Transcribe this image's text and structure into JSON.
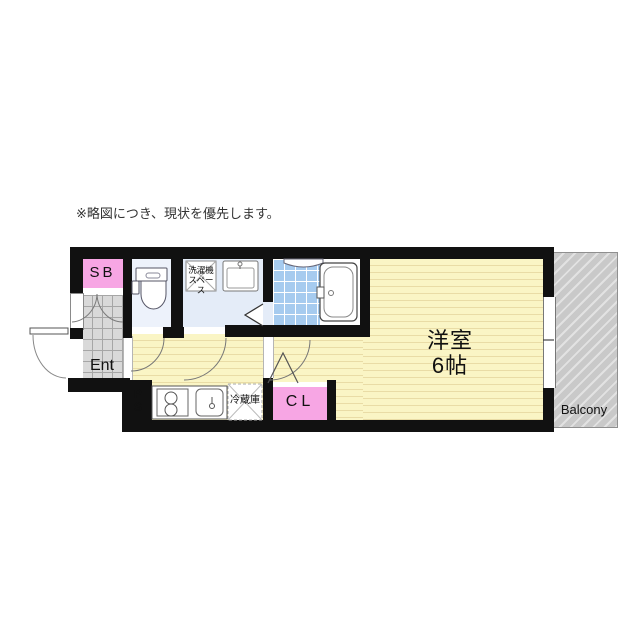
{
  "disclaimer": "※略図につき、現状を優先します。",
  "rooms": {
    "shoe_box": {
      "label": "SB"
    },
    "entrance": {
      "label": "Ent"
    },
    "pipe_space": {
      "top": "P",
      "bottom": "S"
    },
    "closet": {
      "label": "CL"
    },
    "main_room": {
      "name": "洋室",
      "size": "6帖"
    },
    "balcony": {
      "label": "Balcony"
    },
    "kitchen": {
      "fridge_label": "冷蔵庫"
    },
    "washroom": {
      "washer_line1": "洗濯機",
      "washer_line2": "スペース"
    }
  },
  "colors": {
    "wall": "#111111",
    "room_yellow": "#faf5c5",
    "bath_tile_blue": "#a6cbef",
    "sanitary_floor": "#e4ecf8",
    "entrance_tile": "#d9d9d9",
    "closet_pink": "#f7a6e4",
    "balcony_gray": "#c9c9c9"
  }
}
